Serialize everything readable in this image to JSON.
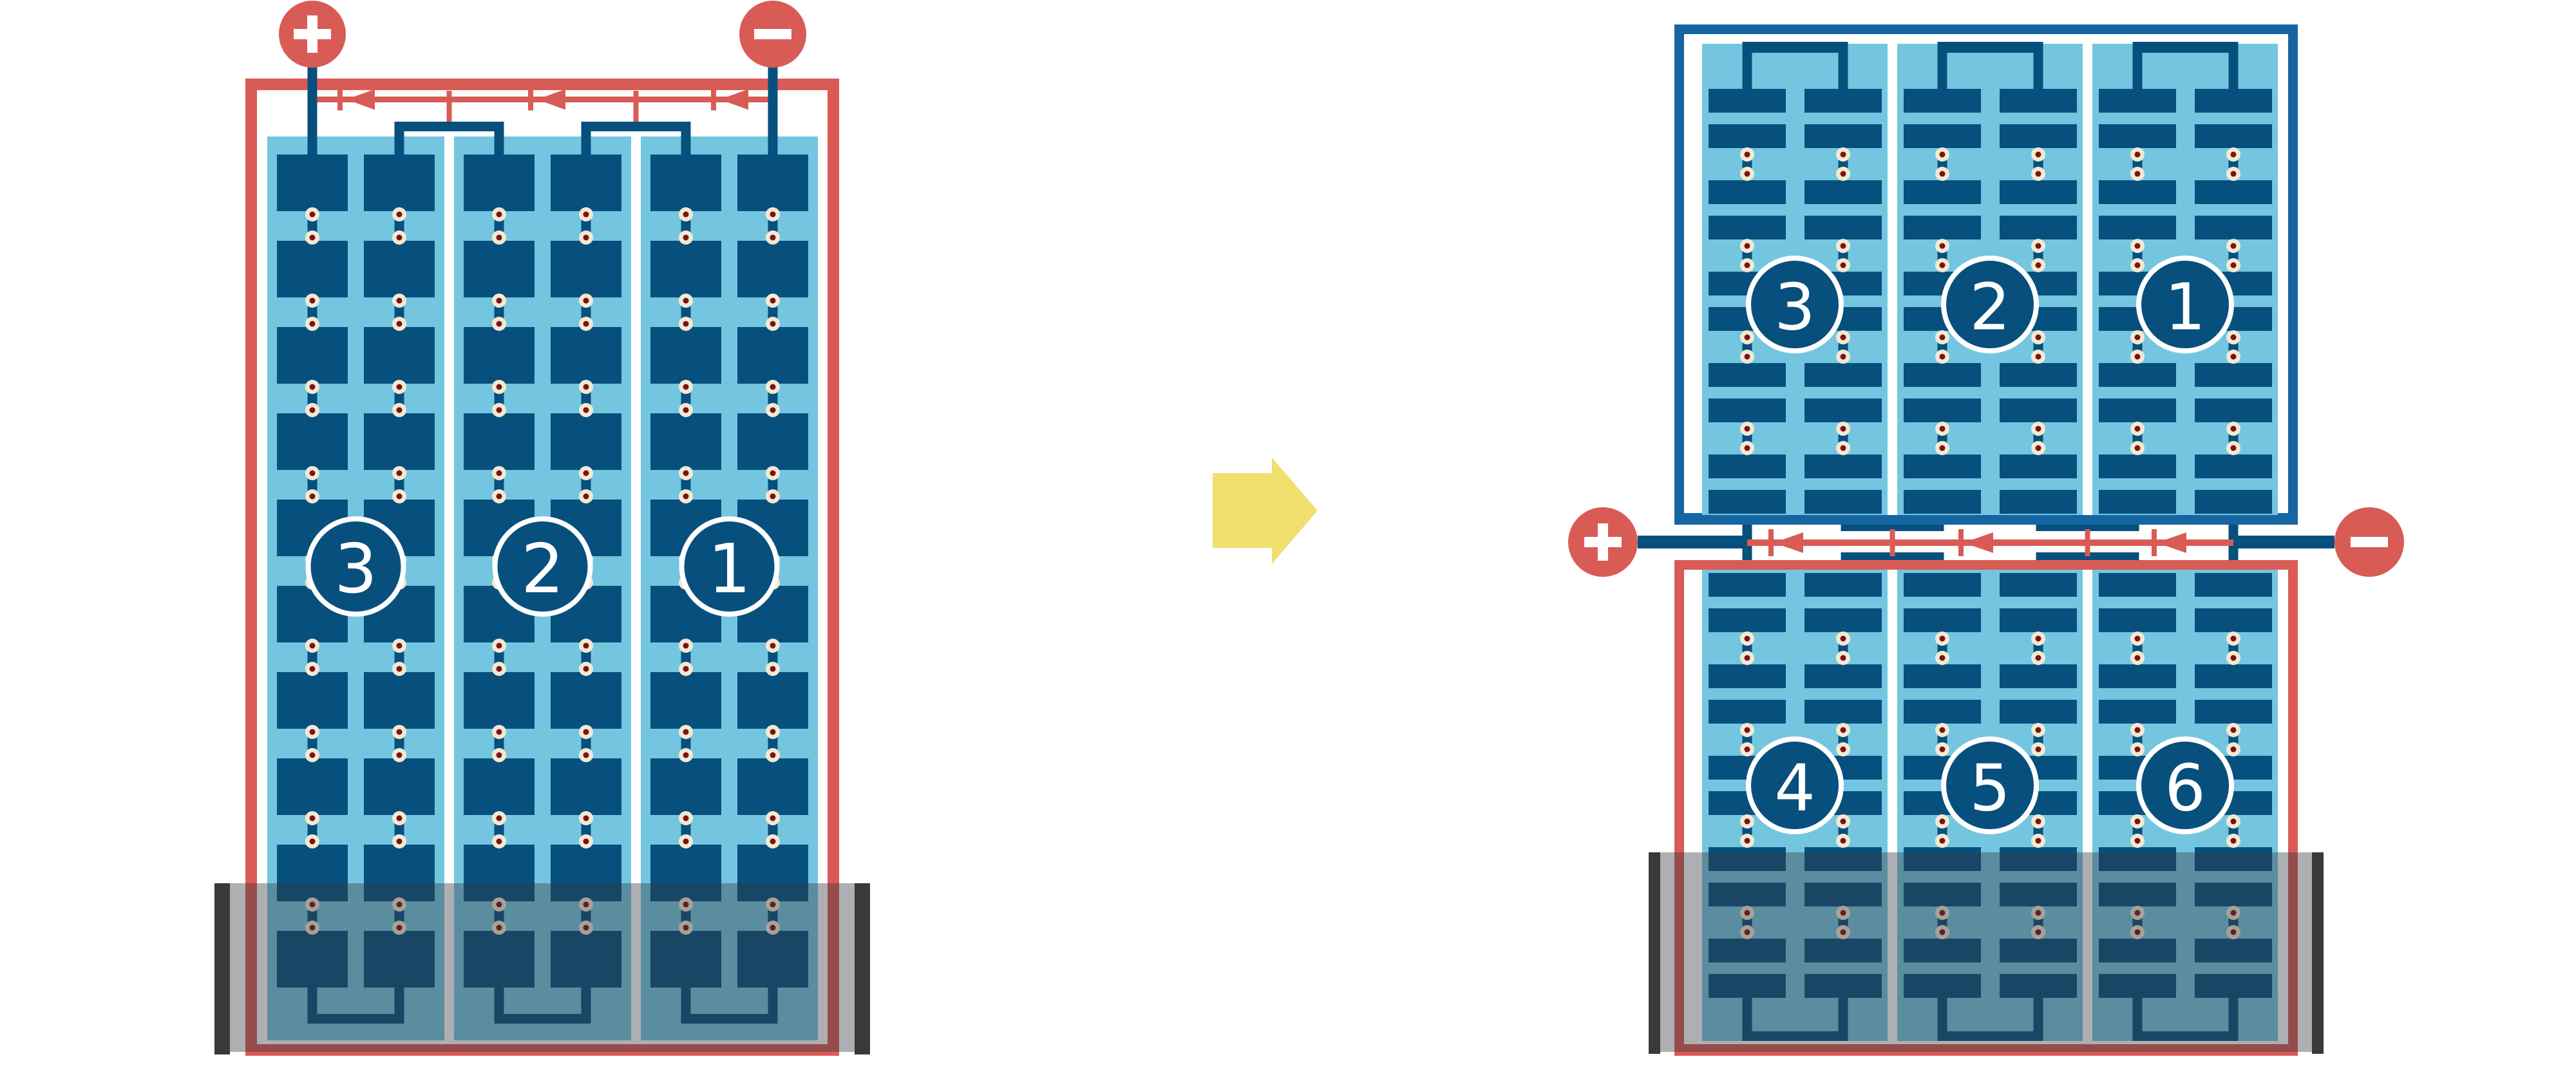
{
  "colors": {
    "red": "#D95B55",
    "navy": "#07507E",
    "frame_blue": "#1565A3",
    "light_blue": "#74C6E0",
    "white": "#FFFFFF",
    "cream": "#F3E9D2",
    "rivet_center": "#7A1414",
    "yellow": "#F2E06E",
    "case_overlay": "rgba(52,56,62,0.40)",
    "case_bar": "#3B3838"
  },
  "left_battery": {
    "cell_labels": [
      "3",
      "2",
      "1"
    ],
    "groups": 3,
    "columns_per_group": 2,
    "cell_rows": 10,
    "terminals": [
      {
        "sign": "+",
        "side": "left"
      },
      {
        "sign": "−",
        "side": "right"
      }
    ]
  },
  "transform_arrow": {
    "direction": "right"
  },
  "right_battery": {
    "top_unit": {
      "cell_labels": [
        "3",
        "2",
        "1"
      ]
    },
    "bottom_unit": {
      "cell_labels": [
        "4",
        "5",
        "6"
      ]
    },
    "groups": 3,
    "columns_per_group": 2,
    "terminals": [
      {
        "sign": "+",
        "side": "left"
      },
      {
        "sign": "−",
        "side": "right"
      }
    ]
  }
}
